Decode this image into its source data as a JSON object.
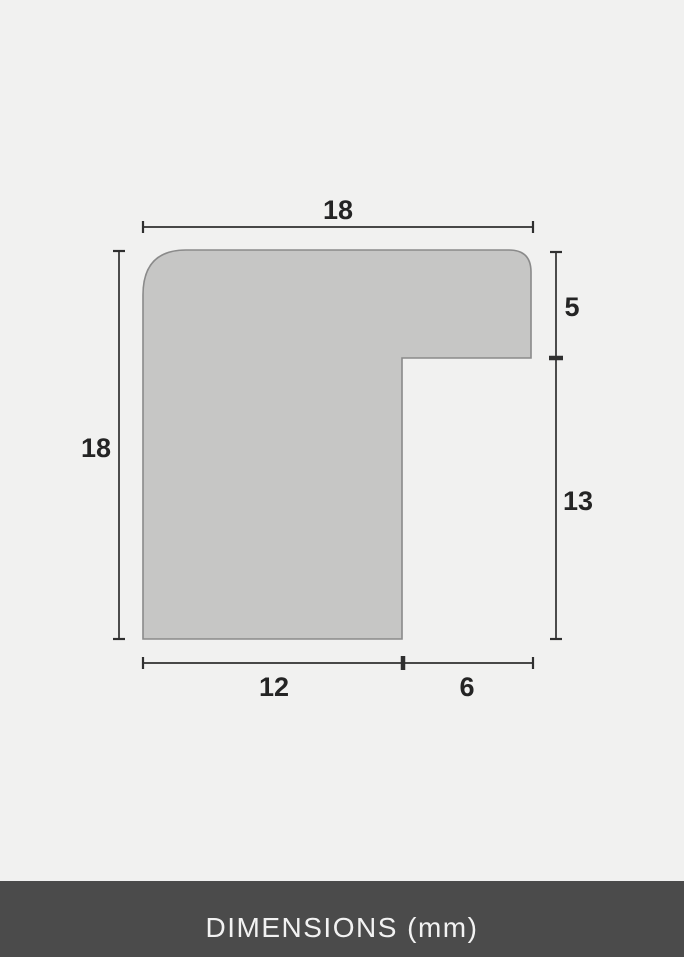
{
  "diagram": {
    "name": "frame-moulding-profile-cross-section",
    "unit": "mm",
    "labels": {
      "top_width": "18",
      "left_height": "18",
      "right_upper": "5",
      "right_lower": "13",
      "bottom_left": "12",
      "bottom_right": "6"
    }
  },
  "footer": {
    "label": "DIMENSIONS (mm)"
  },
  "colors": {
    "background": "#f1f1f0",
    "profile_fill": "#c6c6c5",
    "profile_stroke": "#8a8a8a",
    "dimension_line": "#2f2f2f",
    "label_text": "#242424",
    "footer_background": "#4b4b4b",
    "footer_text": "#f2f2f2"
  }
}
